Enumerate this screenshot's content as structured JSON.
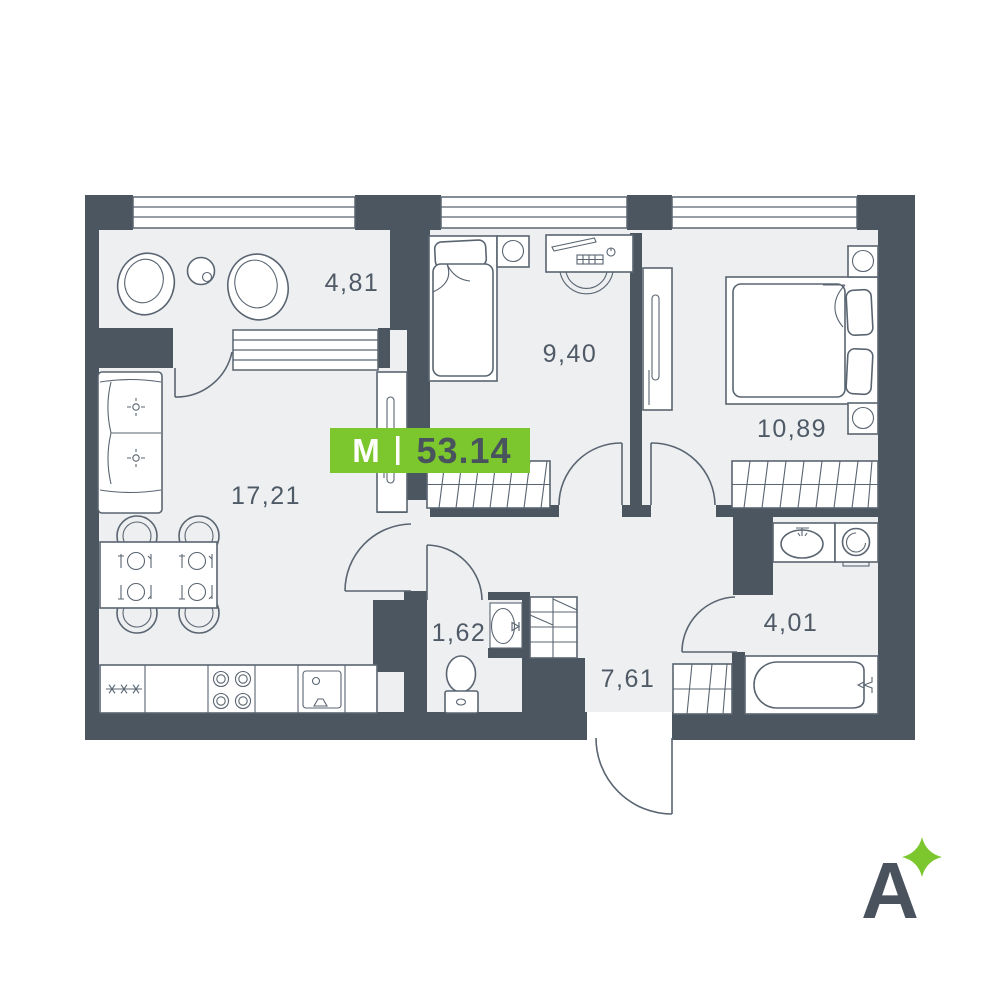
{
  "plan": {
    "badge": {
      "label": "M",
      "total_area": "53.14"
    },
    "rooms": [
      {
        "id": "balcony",
        "area": "4,81"
      },
      {
        "id": "living-kitchen",
        "area": "17,21"
      },
      {
        "id": "bedroom-small",
        "area": "9,40"
      },
      {
        "id": "bedroom-master",
        "area": "10,89"
      },
      {
        "id": "wc",
        "area": "1,62"
      },
      {
        "id": "hallway",
        "area": "7,61"
      },
      {
        "id": "bathroom",
        "area": "4,01"
      }
    ]
  },
  "logo": {
    "letter": "A"
  },
  "colors": {
    "wall": "#4C5661",
    "floor": "#EDEFF1",
    "outline": "#5A6571",
    "accent_green": "#7CC72E",
    "label_text": "#4F5A66",
    "badge_number": "#49535E"
  }
}
